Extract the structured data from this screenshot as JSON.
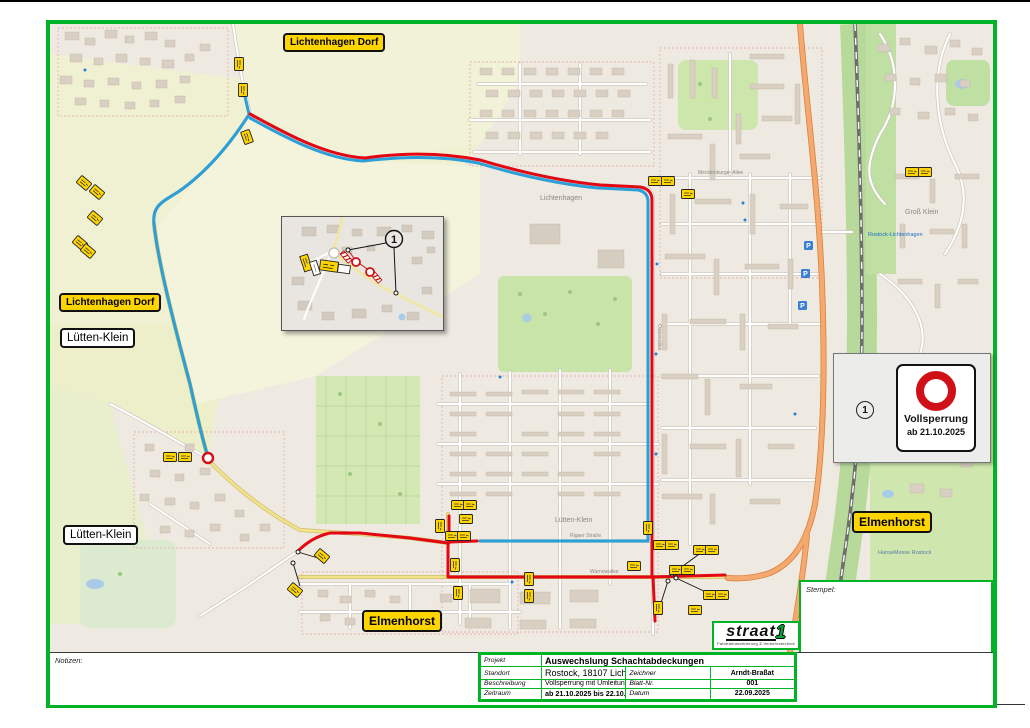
{
  "colors": {
    "frame_green": "#00b327",
    "route_red": "#e30613",
    "route_blue": "#2a9fd8",
    "sign_yellow": "#ffd500",
    "closure_red": "#cf1117",
    "primary_road_orange": "#f5a96f"
  },
  "place_signs": [
    {
      "label": "Lichtenhagen Dorf",
      "style": "yellow"
    },
    {
      "label": "Lichtenhagen Dorf",
      "style": "yellow"
    },
    {
      "label": "Lütten-Klein",
      "style": "white"
    },
    {
      "label": "Lütten-Klein",
      "style": "white"
    },
    {
      "label": "Elmenhorst",
      "style": "yellow"
    },
    {
      "label": "Elmenhorst",
      "style": "yellow"
    }
  ],
  "legend": {
    "number": "1",
    "sign_title": "Vollsperrung",
    "sign_date": "ab 21.10.2025"
  },
  "inset": {
    "number": "1"
  },
  "map": {
    "parking_label": "P",
    "labels": [
      {
        "text": "Lichtenhagen"
      },
      {
        "text": "Lütten-Klein"
      },
      {
        "text": "Mecklenburger Allee"
      },
      {
        "text": "Warnowallee"
      },
      {
        "text": "Rigaer Straße"
      },
      {
        "text": "Elmenhorster Weg"
      },
      {
        "text": "Rostock-Lichtenhagen"
      },
      {
        "text": "Groß Klein"
      },
      {
        "text": "HanseMesse Rostock"
      },
      {
        "text": "Ostseeallee"
      }
    ]
  },
  "notes": {
    "label": "Notizen:"
  },
  "stamp": {
    "label": "Stempel:"
  },
  "logo": {
    "name": "straat",
    "one": "1",
    "tagline": "Fahrbahnmarkierung & Verkehrstechnik"
  },
  "titleblock": {
    "rows": [
      {
        "label": "Projekt",
        "value": "Auswechslung Schachtabdeckungen"
      },
      {
        "label": "Standort",
        "value": "Rostock, 18107 Lichtenhagen, Dorfstraße 9"
      },
      {
        "label": "Beschreibung",
        "value": "Vollsperrung mit Umleitung"
      },
      {
        "label": "Zeitraum",
        "value": "ab 21.10.2025 bis 22.10.2025"
      }
    ],
    "side": [
      {
        "label": "Zeichner",
        "value": "Arndt-Braßat"
      },
      {
        "label": "Blatt-Nr.",
        "value": "001"
      },
      {
        "label": "Datum",
        "value": "22.09.2025"
      }
    ]
  }
}
